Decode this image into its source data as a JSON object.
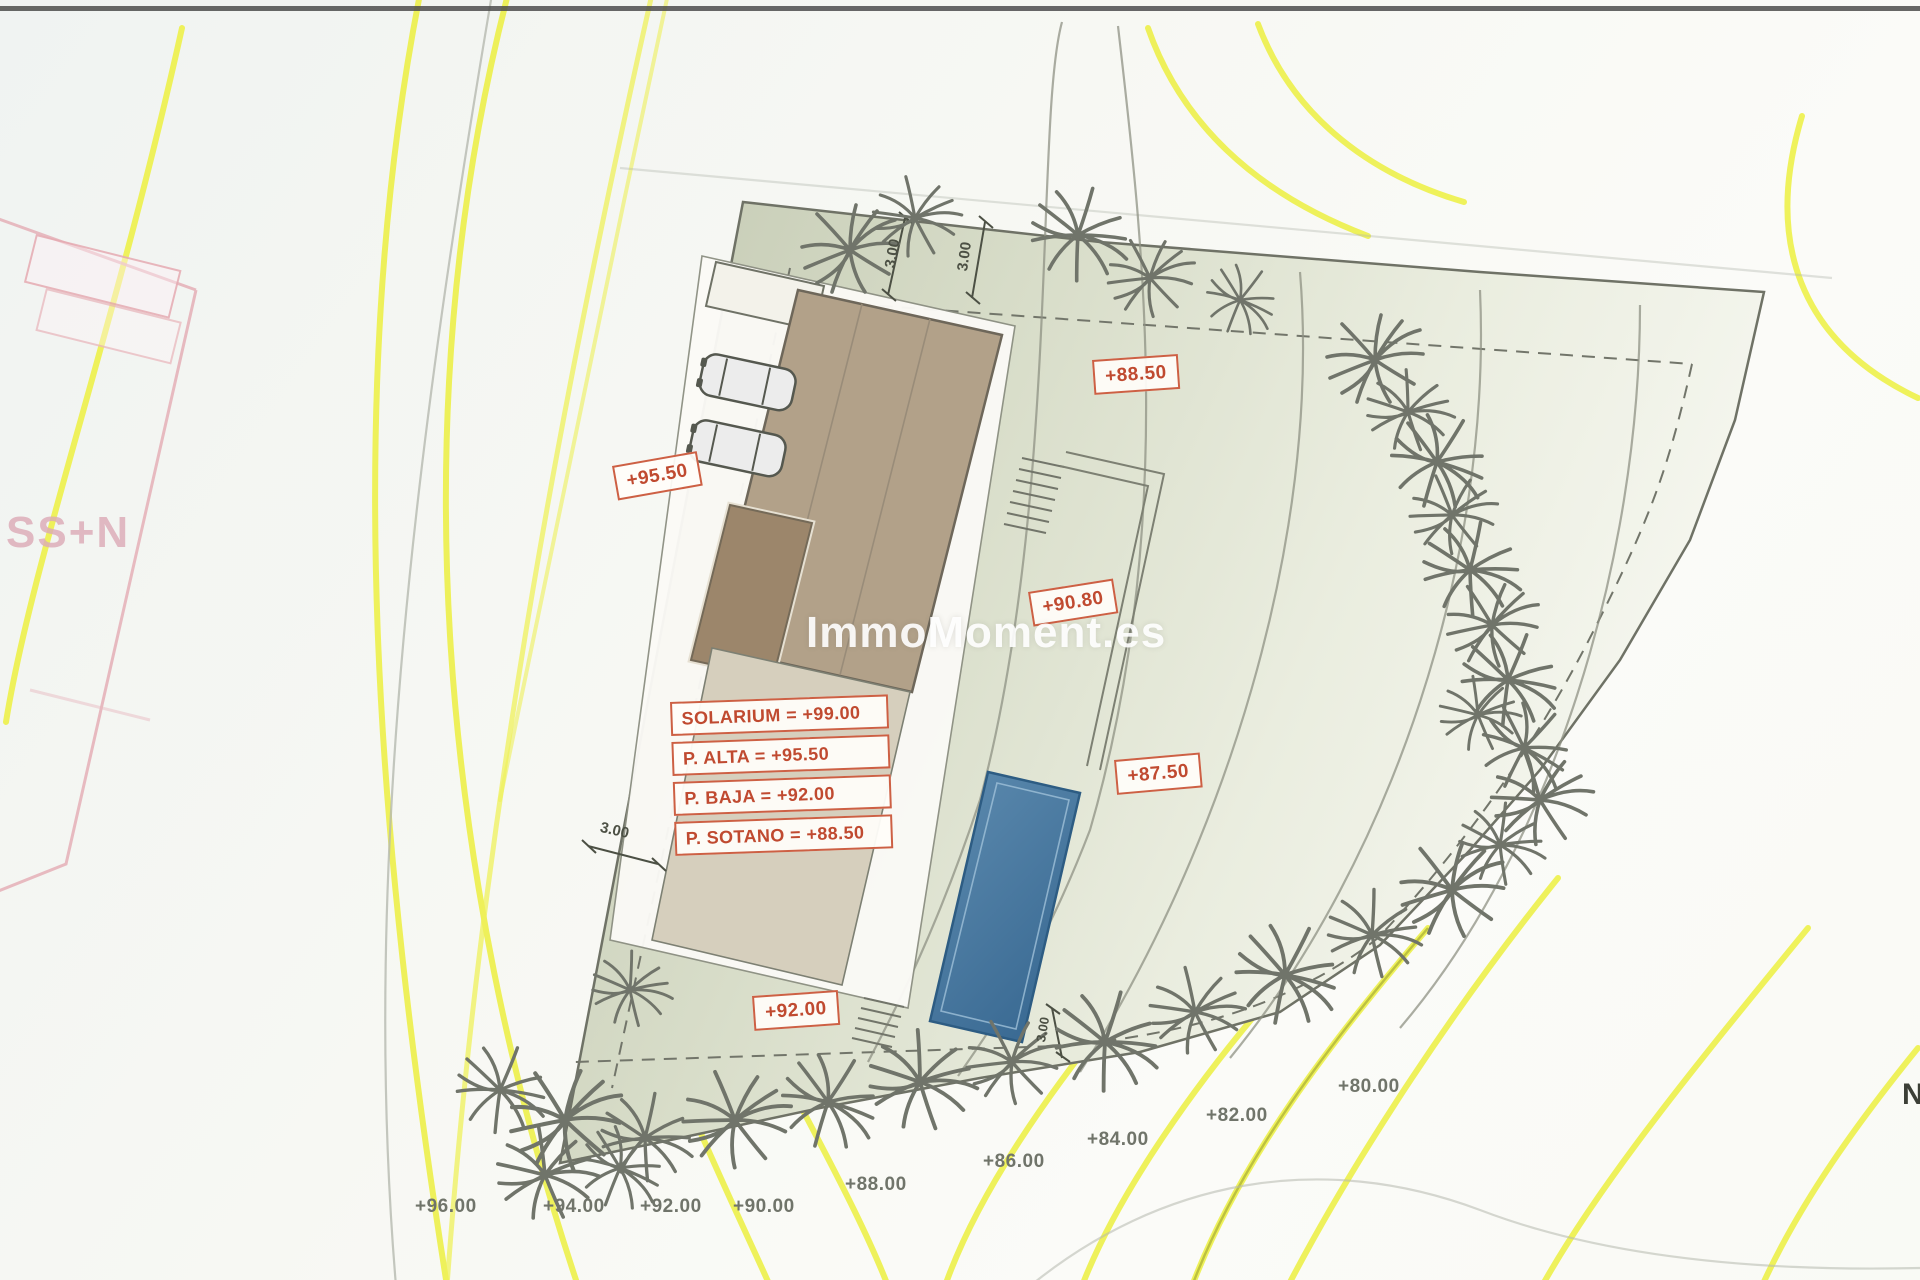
{
  "watermark": {
    "text": "ImmoMoment.es"
  },
  "north": {
    "label": "N"
  },
  "neighbor": {
    "label": "SS+N"
  },
  "elevations": [
    {
      "text": "+95.50"
    },
    {
      "text": "+88.50"
    },
    {
      "text": "+90.80"
    },
    {
      "text": "+87.50"
    },
    {
      "text": "+92.00"
    }
  ],
  "floor_levels": [
    {
      "text": "SOLARIUM = +99.00"
    },
    {
      "text": "P. ALTA = +95.50"
    },
    {
      "text": "P. BAJA = +92.00"
    },
    {
      "text": "P. SOTANO = +88.50"
    }
  ],
  "contour_labels": [
    {
      "text": "+96.00"
    },
    {
      "text": "+94.00"
    },
    {
      "text": "+92.00"
    },
    {
      "text": "+90.00"
    },
    {
      "text": "+88.00"
    },
    {
      "text": "+86.00"
    },
    {
      "text": "+84.00"
    },
    {
      "text": "+82.00"
    },
    {
      "text": "+80.00"
    }
  ],
  "dimensions": [
    {
      "text": "3.00"
    },
    {
      "text": "3.00"
    },
    {
      "text": "3.00"
    },
    {
      "text": "3.00"
    }
  ],
  "colors": {
    "contour_yellow": "#edf046",
    "parcel_green": "#c5cbb4",
    "roof_tan": "#b2a189",
    "roof_dark": "#9c866b",
    "pool_blue": "#4d7da4",
    "label_red": "#c04a30",
    "tree_gray": "#70746a"
  }
}
